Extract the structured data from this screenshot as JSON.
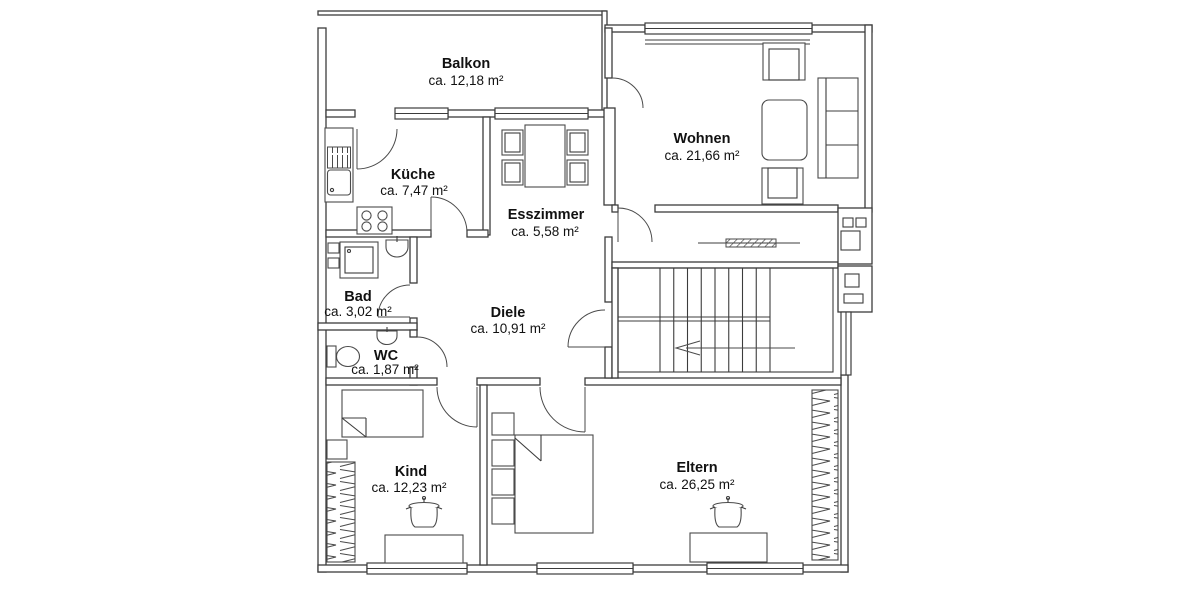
{
  "meta": {
    "drawing_type": "apartment floor plan",
    "language": "de"
  },
  "colors": {
    "background": "#ffffff",
    "wall_line": "#3c3c3c",
    "furniture_line": "#4a4a4a",
    "text": "#111111"
  },
  "rooms": {
    "balkon": {
      "name": "Balkon",
      "area": "ca. 12,18 m²"
    },
    "kueche": {
      "name": "Küche",
      "area": "ca. 7,47 m²"
    },
    "esszimmer": {
      "name": "Esszimmer",
      "area": "ca. 5,58 m²"
    },
    "wohnen": {
      "name": "Wohnen",
      "area": "ca. 21,66 m²"
    },
    "bad": {
      "name": "Bad",
      "area": "ca. 3,02 m²"
    },
    "diele": {
      "name": "Diele",
      "area": "ca. 10,91 m²"
    },
    "wc": {
      "name": "WC",
      "area": "ca. 1,87 m²"
    },
    "kind": {
      "name": "Kind",
      "area": "ca. 12,23 m²"
    },
    "eltern": {
      "name": "Eltern",
      "area": "ca. 26,25 m²"
    }
  }
}
